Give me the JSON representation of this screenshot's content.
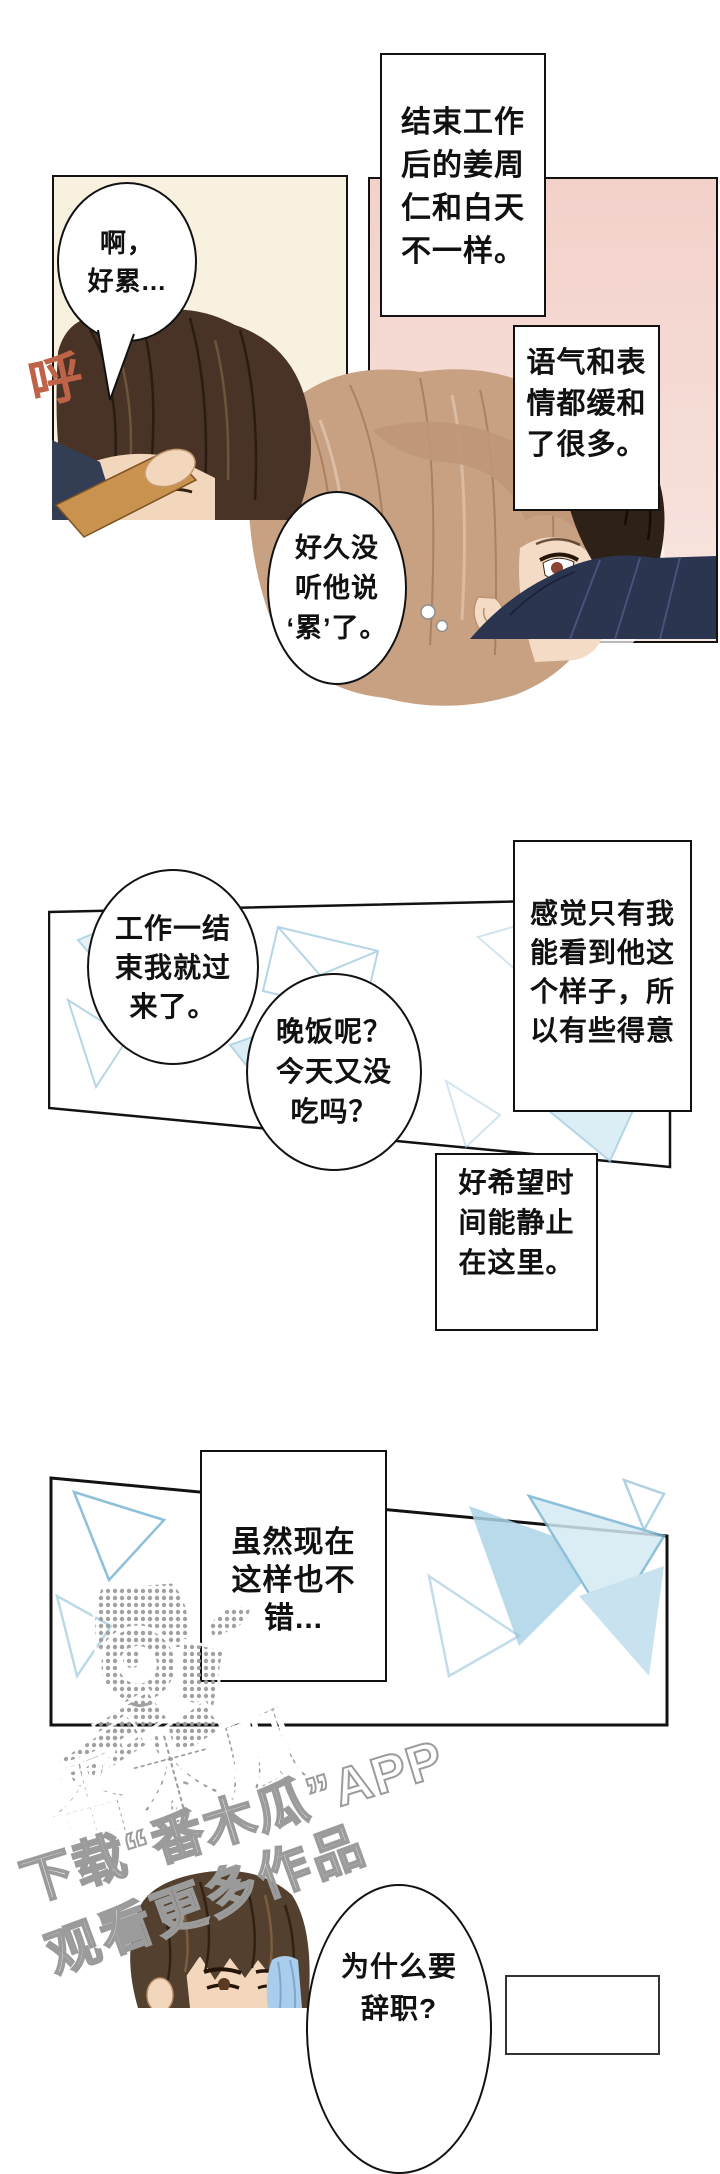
{
  "page": {
    "width": 720,
    "height": 2008,
    "background": "#ffffff"
  },
  "colors": {
    "panel_cream": "#f8f1df",
    "panel_pink_top": "#f2d1ca",
    "panel_pink_bottom": "#f9e6e1",
    "pattern_blue": "#9cc8dd",
    "sfx_orange": "#bf6348",
    "hair_dark_brown": "#483326",
    "hair_light_brown": "#c8a183",
    "clothing_navy": "#2b3550",
    "sleeve_tan": "#c9924f",
    "skin": "#f2d7bd",
    "watermark_gray": "#9a9a9a"
  },
  "section_top": {
    "narration_box_1": {
      "lines": [
        "结束工作",
        "后的姜周",
        "仁和白天",
        "不一样。"
      ]
    },
    "speech_bubble_tired": {
      "lines": [
        "啊，",
        "好累..."
      ]
    },
    "sfx_sigh": "呼",
    "narration_box_2": {
      "lines": [
        "语气和表",
        "情都缓和",
        "了很多。"
      ]
    },
    "speech_bubble_long_time": {
      "lines": [
        "好久没",
        "听他说",
        "‘累’了。"
      ]
    }
  },
  "section_middle": {
    "speech_bubble_came_over": {
      "lines": [
        "工作一结",
        "束我就过",
        "来了。"
      ]
    },
    "speech_bubble_dinner": {
      "lines": [
        "晚饭呢？",
        "今天又没",
        "吃吗？"
      ]
    },
    "narration_box_3": {
      "lines": [
        "感觉只有我",
        "能看到他这",
        "个样子，所",
        "以有些得意"
      ]
    },
    "narration_box_4": {
      "lines": [
        "好希望时",
        "间能静止",
        "在这里。"
      ]
    }
  },
  "section_lower": {
    "narration_box_5": {
      "lines": [
        "虽然现在",
        "这样也不",
        "错..."
      ]
    }
  },
  "watermark": {
    "logo_text": "番木瓜",
    "line1": "下载“番木瓜”APP",
    "line2": "观看更多作品"
  },
  "section_bottom": {
    "speech_bubble_resign": {
      "lines": [
        "为什么要",
        "辞职?"
      ]
    }
  }
}
